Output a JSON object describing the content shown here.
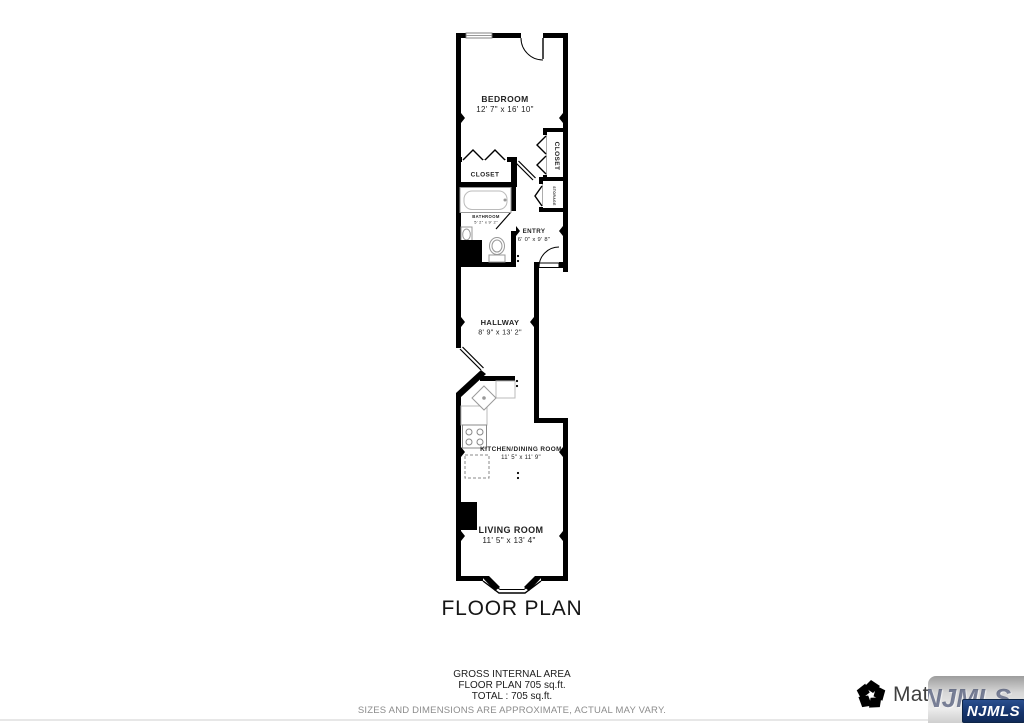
{
  "plan": {
    "title": "FLOOR PLAN",
    "rooms": {
      "bedroom": {
        "name": "BEDROOM",
        "dims": "12' 7\" x 16' 10\""
      },
      "closet_left": {
        "name": "CLOSET"
      },
      "closet_right": {
        "name": "CLOSET"
      },
      "storage": {
        "name": "STORAGE"
      },
      "bathroom": {
        "name": "BATHROOM",
        "dims": "5' 2\" x 9' 2\""
      },
      "entry": {
        "name": "ENTRY",
        "dims": "6' 0\" x 9' 8\""
      },
      "hallway": {
        "name": "HALLWAY",
        "dims": "8' 9\" x 13' 2\""
      },
      "kitchen": {
        "name": "KITCHEN/DINING ROOM",
        "dims": "11' 5\" x 11' 9\""
      },
      "living": {
        "name": "LIVING ROOM",
        "dims": "11' 5\" x 13' 4\""
      }
    }
  },
  "summary": {
    "line1": "GROSS INTERNAL AREA",
    "line2": "FLOOR PLAN 705 sq.ft.",
    "line3": "TOTAL :  705 sq.ft.",
    "disclaimer": "SIZES AND DIMENSIONS ARE APPROXIMATE, ACTUAL MAY VARY."
  },
  "branding": {
    "matterport_wordmark": "Matterport",
    "njmls_badge": "NJMLS",
    "njmls_watermark": "NJMLS",
    "colors": {
      "wall": "#000000",
      "njmls_navy": "#16356d"
    }
  }
}
